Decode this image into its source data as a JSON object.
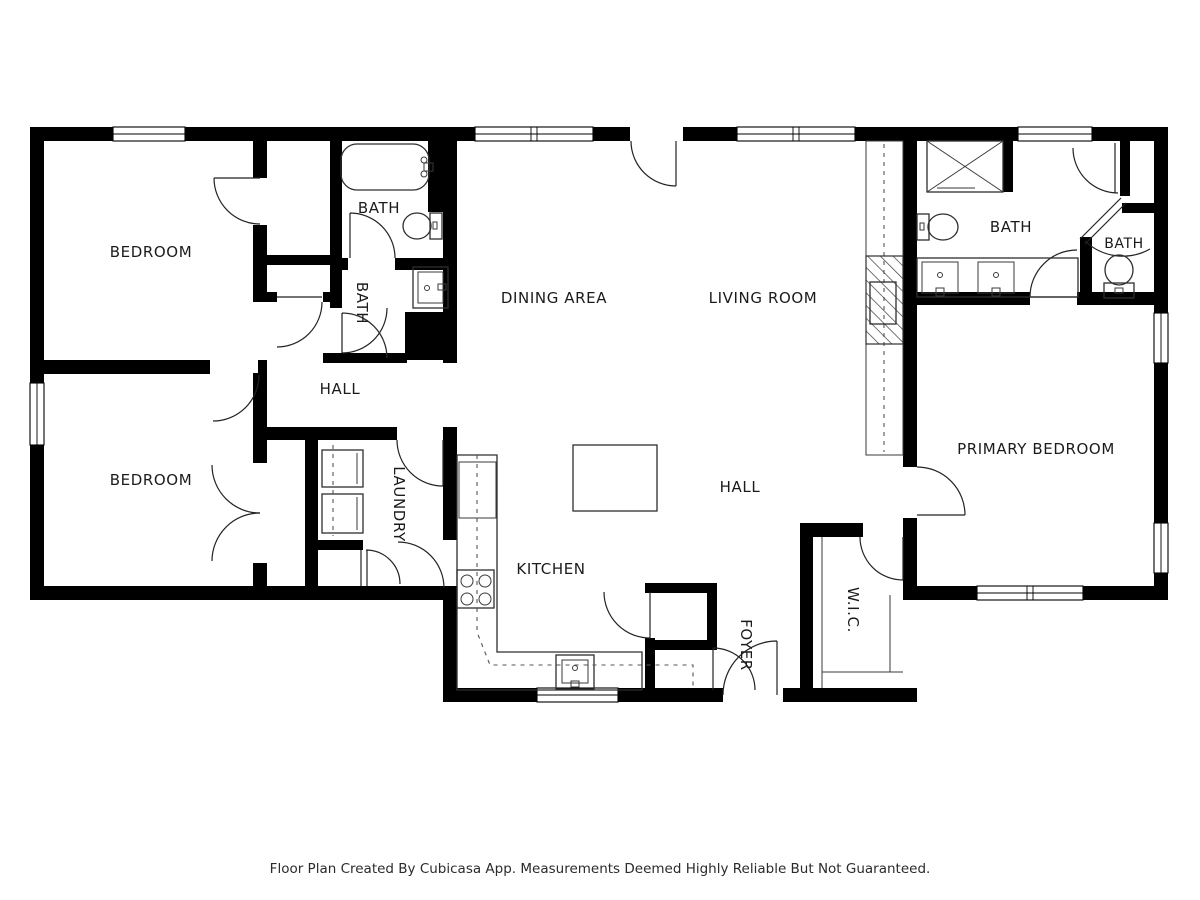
{
  "floor_plan": {
    "app_credit_caption": "Floor Plan Created By Cubicasa App. Measurements Deemed Highly Reliable But Not Guaranteed.",
    "wall_color": "#000000",
    "line_color": "#333333",
    "background_color": "#ffffff",
    "rooms": [
      {
        "id": "bedroom-1",
        "label": "BEDROOM",
        "x": 151,
        "y": 252,
        "vertical": false
      },
      {
        "id": "bath-1",
        "label": "BATH",
        "x": 379,
        "y": 208,
        "vertical": false
      },
      {
        "id": "bath-2",
        "label": "BATH",
        "x": 362,
        "y": 303,
        "vertical": true
      },
      {
        "id": "dining-area",
        "label": "DINING AREA",
        "x": 554,
        "y": 298,
        "vertical": false
      },
      {
        "id": "living-room",
        "label": "LIVING ROOM",
        "x": 763,
        "y": 298,
        "vertical": false
      },
      {
        "id": "bath-3",
        "label": "BATH",
        "x": 1011,
        "y": 227,
        "vertical": false
      },
      {
        "id": "bath-4",
        "label": "BATH",
        "x": 1124,
        "y": 244,
        "vertical": false
      },
      {
        "id": "hall-west",
        "label": "HALL",
        "x": 340,
        "y": 389,
        "vertical": false
      },
      {
        "id": "bedroom-2",
        "label": "BEDROOM",
        "x": 151,
        "y": 480,
        "vertical": false
      },
      {
        "id": "laundry",
        "label": "LAUNDRY",
        "x": 399,
        "y": 504,
        "vertical": true
      },
      {
        "id": "kitchen",
        "label": "KITCHEN",
        "x": 551,
        "y": 569,
        "vertical": false
      },
      {
        "id": "hall-center",
        "label": "HALL",
        "x": 740,
        "y": 487,
        "vertical": false
      },
      {
        "id": "foyer",
        "label": "FOYER",
        "x": 746,
        "y": 645,
        "vertical": true
      },
      {
        "id": "wic",
        "label": "W.I.C.",
        "x": 853,
        "y": 610,
        "vertical": true
      },
      {
        "id": "primary-bedroom",
        "label": "PRIMARY BEDROOM",
        "x": 1036,
        "y": 449,
        "vertical": false
      }
    ]
  }
}
